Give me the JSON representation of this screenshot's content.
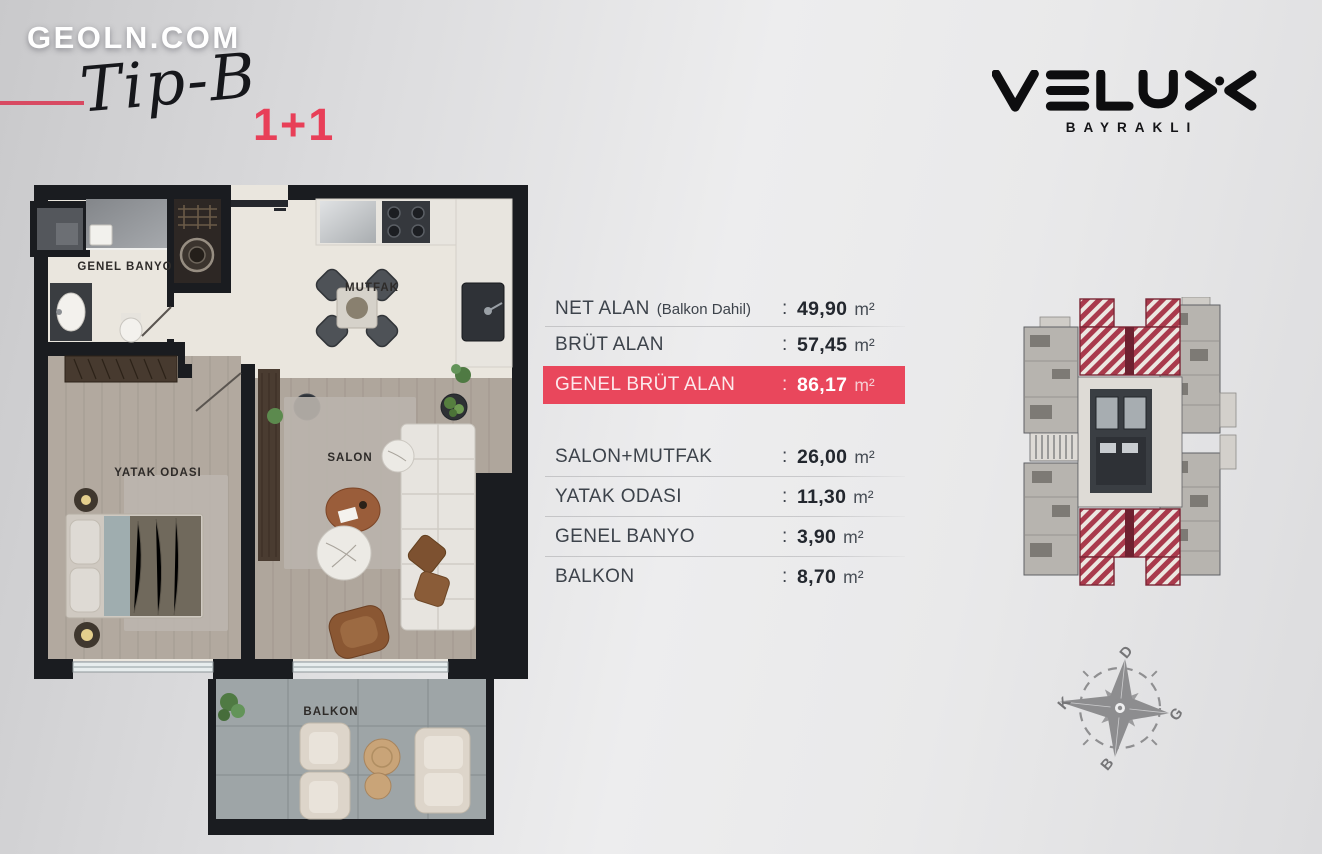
{
  "branding": {
    "site_logo": "GEOLN.COM",
    "plan_type": "Tip-B",
    "room_config": "1+1"
  },
  "developer_logo": {
    "name": "VELUX",
    "location": "BAYRAKLI"
  },
  "area_table": {
    "colon": ":",
    "summary_rows": [
      {
        "label": "NET ALAN",
        "note": "(Balkon Dahil)",
        "value": "49,90",
        "unit": "m²"
      },
      {
        "label": "BRÜT ALAN",
        "note": "",
        "value": "57,45",
        "unit": "m²"
      },
      {
        "label": "GENEL BRÜT ALAN",
        "note": "",
        "value": "86,17",
        "unit": "m²"
      }
    ],
    "room_rows": [
      {
        "label": "SALON+MUTFAK",
        "value": "26,00",
        "unit": "m²"
      },
      {
        "label": "YATAK ODASI",
        "value": "11,30",
        "unit": "m²"
      },
      {
        "label": "GENEL BANYO",
        "value": "3,90",
        "unit": "m²"
      },
      {
        "label": "BALKON",
        "value": "8,70",
        "unit": "m²"
      }
    ]
  },
  "floor_plan": {
    "labels": {
      "bathroom": "GENEL BANYO",
      "kitchen": "MUTFAK",
      "bedroom": "YATAK ODASI",
      "living": "SALON",
      "balcony": "BALKON"
    }
  },
  "compass": {
    "north_label": "K",
    "east_label": "D",
    "south_label": "G",
    "west_label": "B"
  },
  "colors": {
    "accent_pink": "#e9475c",
    "accent_line": "#d84a62",
    "wall_black": "#1a1c20",
    "stripe_red": "#a93a4c"
  }
}
